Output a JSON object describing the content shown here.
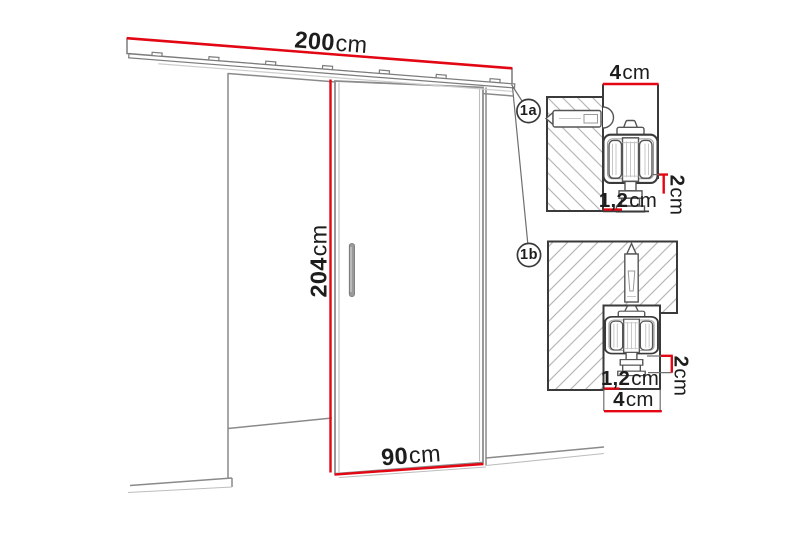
{
  "title": "Sliding door with top rail - assembly dimension diagram",
  "diagram": {
    "main": {
      "rail_width": {
        "value": "200",
        "unit": "cm"
      },
      "door_height": {
        "value": "204",
        "unit": "cm"
      },
      "door_width": {
        "value": "90",
        "unit": "cm"
      }
    },
    "callouts": {
      "a": {
        "label": "1a"
      },
      "b": {
        "label": "1b"
      }
    },
    "detail_a": {
      "track_depth": {
        "value": "4",
        "unit": "cm"
      },
      "wall_gap": {
        "value": "1,2",
        "unit": "cm"
      },
      "floor_clearance": {
        "value": "2",
        "unit": "cm"
      }
    },
    "detail_b": {
      "floor_clearance": {
        "value": "2",
        "unit": "cm"
      },
      "wall_gap": {
        "value": "1,2",
        "unit": "cm"
      },
      "track_depth": {
        "value": "4",
        "unit": "cm"
      }
    },
    "colors": {
      "dimension_red": "#e30613",
      "outline_gray": "#8a8a8a",
      "detail_dark": "#3a3a3a",
      "hatch_gray": "#b8b8b8",
      "text_black": "#1d1d1b",
      "background": "#ffffff"
    }
  }
}
